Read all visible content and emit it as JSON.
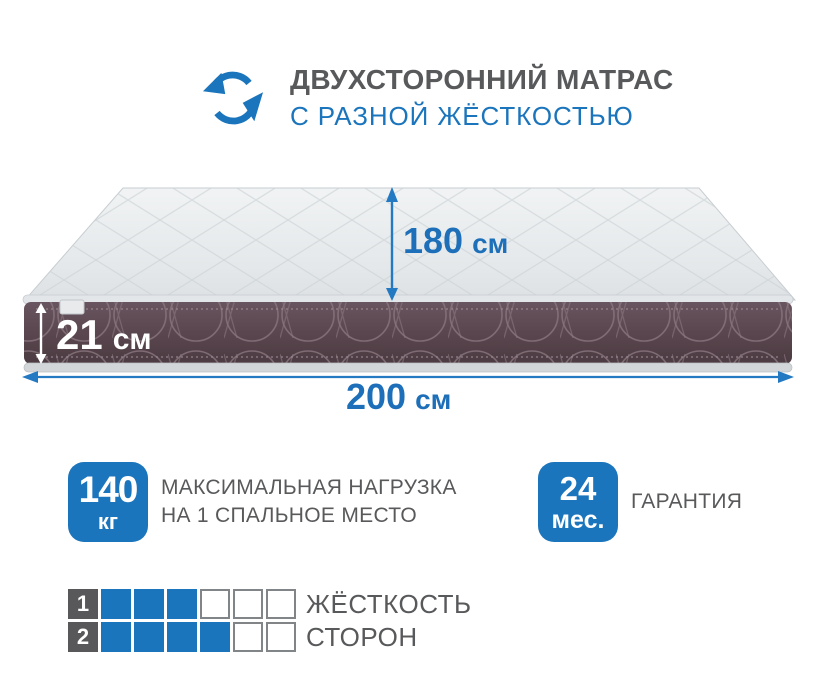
{
  "header": {
    "icon": "rotate-arrows",
    "title": "ДВУХСТОРОННИЙ МАТРАС",
    "subtitle": "С РАЗНОЙ ЖЁСТКОСТЬЮ"
  },
  "mattress": {
    "dimensions": {
      "depth": {
        "value": "180",
        "unit": "см"
      },
      "height": {
        "value": "21",
        "unit": "см"
      },
      "width": {
        "value": "200",
        "unit": "см"
      }
    }
  },
  "specs": [
    {
      "badge_value": "140",
      "badge_unit": "кг",
      "label_line1": "МАКСИМАЛЬНАЯ НАГРУЗКА",
      "label_line2": "НА 1 СПАЛЬНОЕ МЕСТО"
    },
    {
      "badge_value": "24",
      "badge_unit": "мес.",
      "label_line1": "ГАРАНТИЯ",
      "label_line2": ""
    }
  ],
  "firmness": {
    "rows": [
      {
        "side": "1",
        "filled": 3,
        "total": 6
      },
      {
        "side": "2",
        "filled": 4,
        "total": 6
      }
    ],
    "label_line1": "ЖЁСТКОСТЬ",
    "label_line2": "СТОРОН"
  },
  "colors": {
    "accent_blue": "#1b75bc",
    "dimension_blue": "#1c6fb8",
    "arrow_blue": "#2379c2",
    "text_gray": "#58595b",
    "label_square_gray": "#58585a",
    "mattress_side": "#5a464e",
    "mattress_top": "#e7eaec"
  }
}
